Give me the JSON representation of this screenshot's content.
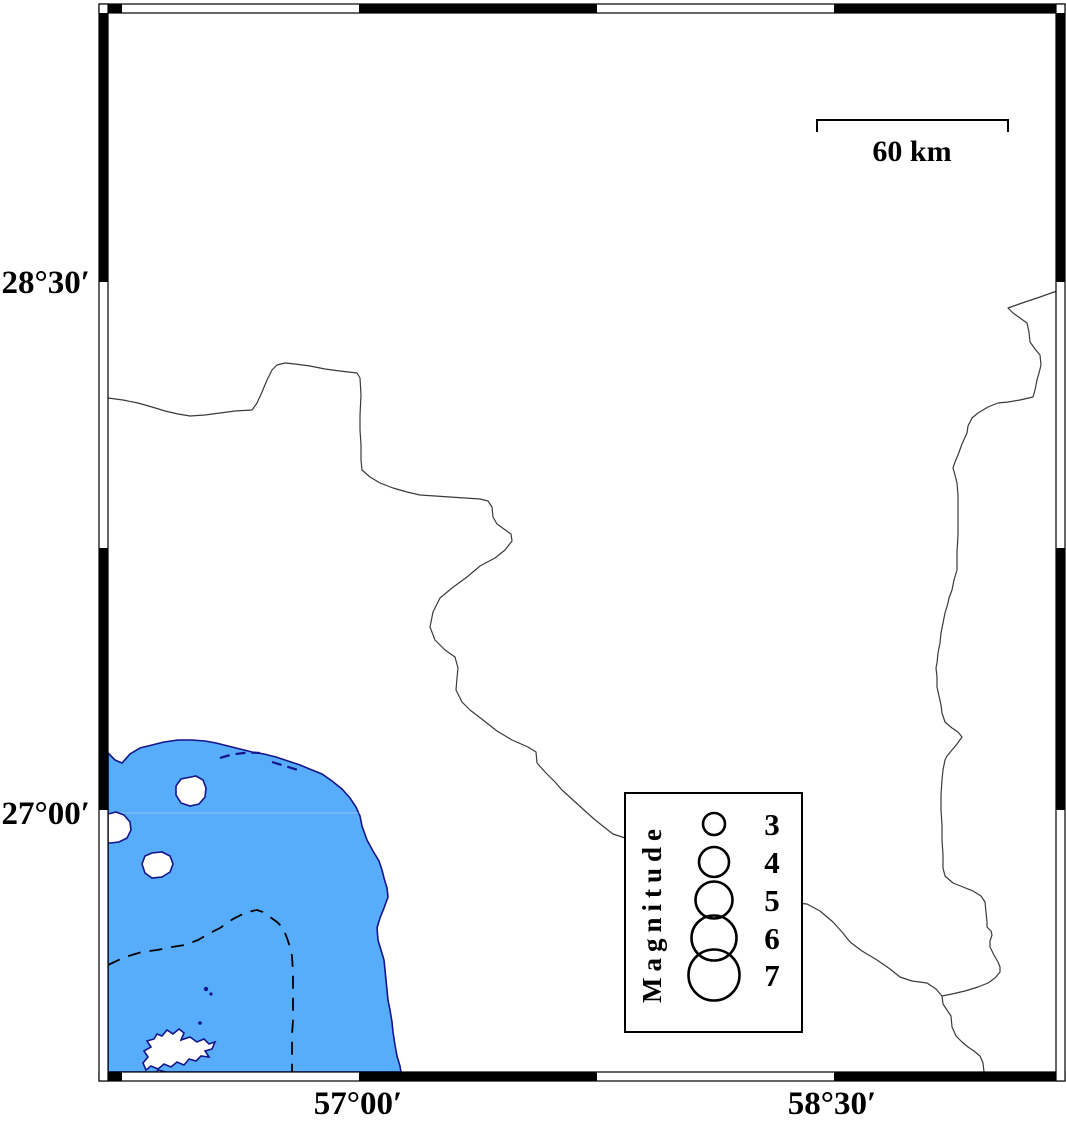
{
  "map_frame": {
    "latitude_labels": [
      "28°30′",
      "27°00′"
    ],
    "longitude_labels": [
      "57°00′",
      "58°30′"
    ]
  },
  "scale_bar": {
    "label": "60 km"
  },
  "legend": {
    "title": "Magnitude",
    "entries": [
      {
        "magnitude": "3",
        "radius": 11
      },
      {
        "magnitude": "4",
        "radius": 15
      },
      {
        "magnitude": "5",
        "radius": 18.5
      },
      {
        "magnitude": "6",
        "radius": 22.5
      },
      {
        "magnitude": "7",
        "radius": 25.5
      }
    ]
  },
  "colors": {
    "sea": "#57ADFA",
    "coastline": "#14148C",
    "boundary": "#3A3A3A",
    "frame": "#000000",
    "background": "#FFFFFF"
  }
}
